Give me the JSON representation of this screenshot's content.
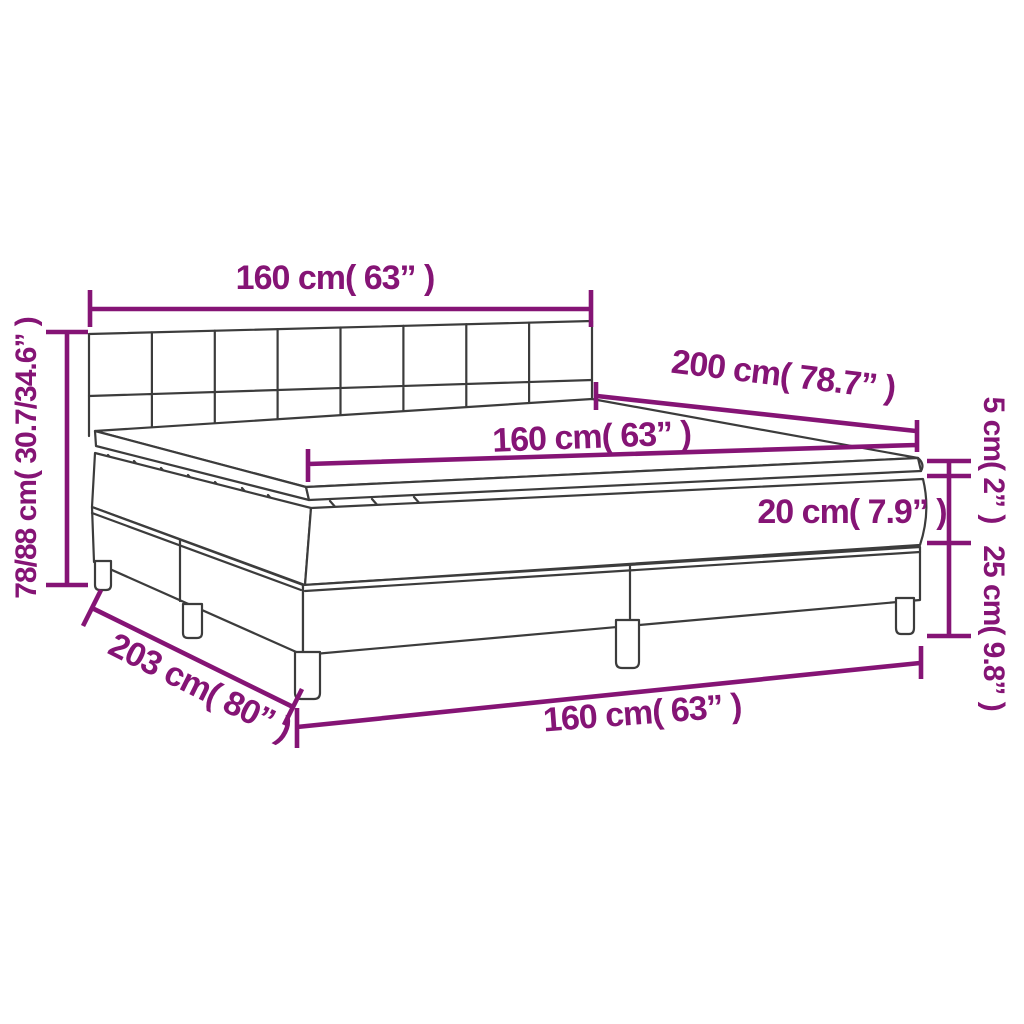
{
  "diagram": {
    "title": "Box spring bed with mattress and topper — dimension diagram",
    "colors": {
      "dimension_accent": "#851475",
      "line_art": "#3c3c3c",
      "background": "#ffffff"
    },
    "labels": {
      "headboard_width": "160 cm( 63” )",
      "overall_height": "78/88 cm( 30.7/34.6” )",
      "mattress_length": "200 cm( 78.7” )",
      "mattress_width": "160 cm( 63” )",
      "mattress_thickness": "20 cm( 7.9” )",
      "topper_thickness": "5 cm( 2” )",
      "box_spring_height": "25 cm( 9.8” )",
      "overall_length": "203 cm( 80” )",
      "base_width": "160 cm( 63” )"
    }
  }
}
